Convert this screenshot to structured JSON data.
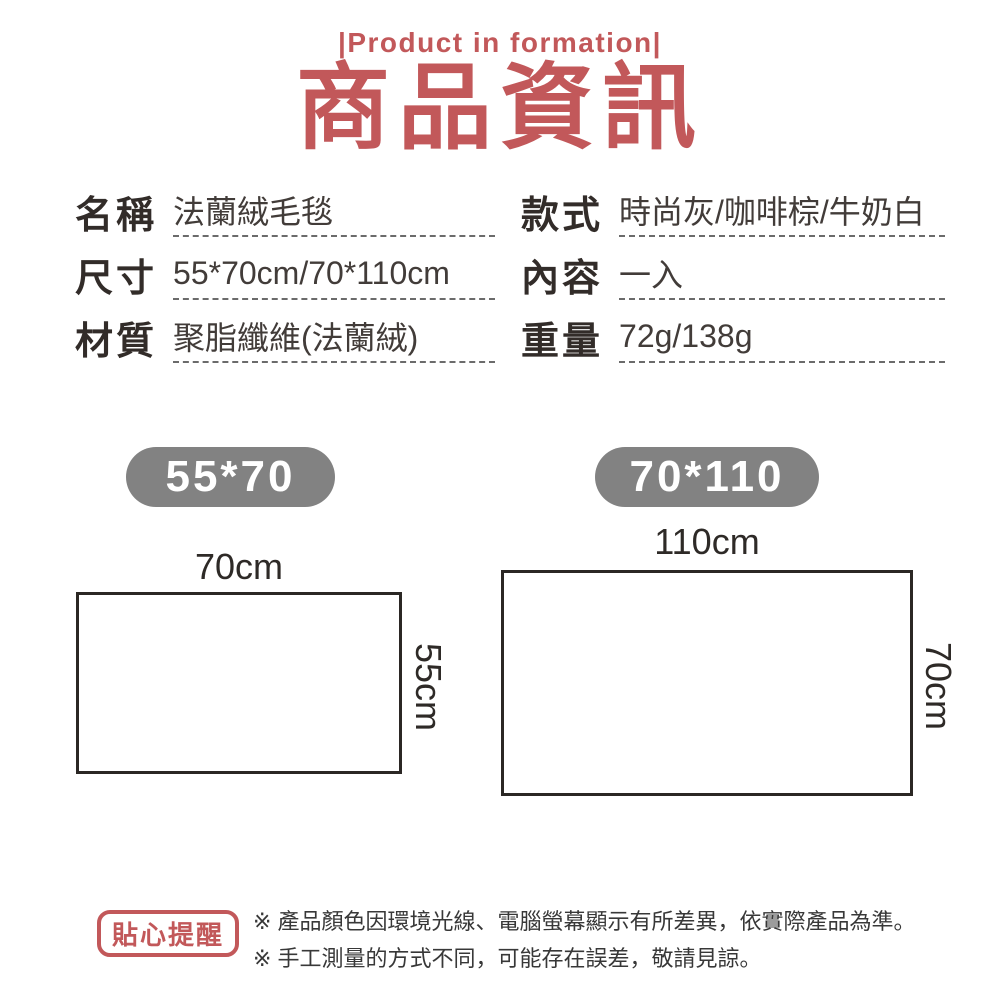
{
  "theme": {
    "accent_red": "#c2585a",
    "badge_gray": "#828282",
    "text_dark": "#322c29",
    "line_dark": "#2b2724"
  },
  "header": {
    "eyebrow": "|Product in formation|",
    "title": "商品資訊"
  },
  "specs": {
    "left": [
      {
        "label": "名稱",
        "value": "法蘭絨毛毯"
      },
      {
        "label": "尺寸",
        "value": "55*70cm/70*110cm"
      },
      {
        "label": "材質",
        "value": "聚脂纖維(法蘭絨)"
      }
    ],
    "right": [
      {
        "label": "款式",
        "value": "時尚灰/咖啡棕/牛奶白"
      },
      {
        "label": "內容",
        "value": "一入"
      },
      {
        "label": "重量",
        "value": "72g/138g"
      }
    ]
  },
  "diagrams": [
    {
      "badge": "55*70",
      "width_label": "70cm",
      "height_label": "55cm"
    },
    {
      "badge": "70*110",
      "width_label": "110cm",
      "height_label": "70cm"
    }
  ],
  "reminder": {
    "badge": "貼心提醒",
    "notes": [
      "※ 產品顏色因環境光線、電腦螢幕顯示有所差異，依實際產品為準。",
      "※ 手工測量的方式不同，可能存在誤差，敬請見諒。"
    ]
  }
}
